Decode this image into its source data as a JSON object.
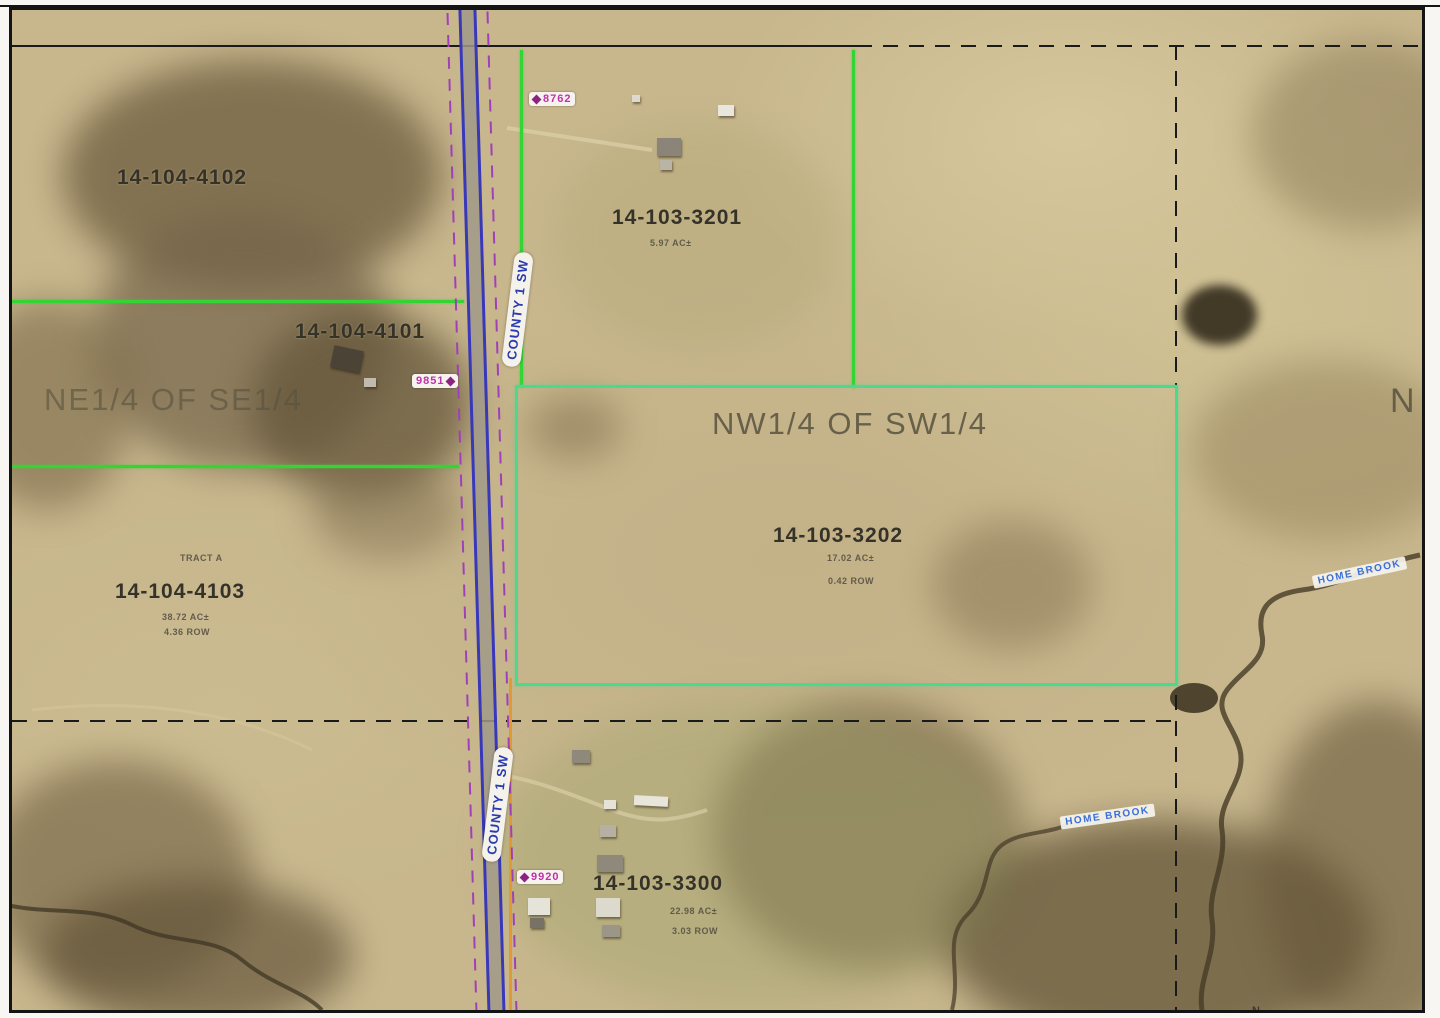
{
  "quarter_section_labels": [
    {
      "text": "NE1/4 OF SE1/4"
    },
    {
      "text": "NW1/4 OF SW1/4"
    },
    {
      "text": "N"
    }
  ],
  "parcels": [
    {
      "id": "14-104-4102"
    },
    {
      "id": "14-103-3201",
      "acreage": "5.97 AC±"
    },
    {
      "id": "14-104-4101"
    },
    {
      "id": "14-103-3202",
      "acreage": "17.02 AC±",
      "row": "0.42 ROW"
    },
    {
      "id": "14-104-4103",
      "tract": "TRACT A",
      "acreage": "38.72 AC±",
      "row": "4.36 ROW"
    },
    {
      "id": "14-103-3300",
      "acreage": "22.98 AC±",
      "row": "3.03 ROW"
    }
  ],
  "road": {
    "name": "COUNTY 1 SW"
  },
  "address_markers": [
    {
      "number": "8762"
    },
    {
      "number": "9851"
    },
    {
      "number": "9920"
    }
  ],
  "streams": [
    {
      "name": "HOME BROOK"
    },
    {
      "name": "HOME BROOK"
    }
  ],
  "north_indicator": "N",
  "colors": {
    "section_line_green": "#35d435",
    "parcel_outline_teal": "#4cd98f",
    "row_line_orange": "#e09a35",
    "road_blue": "#3838b8",
    "road_dash_purple": "#a040b8",
    "address_pink": "#c032a8",
    "stream_label_blue": "#3a6fd8",
    "section_line_black": "#1a1a1a"
  }
}
